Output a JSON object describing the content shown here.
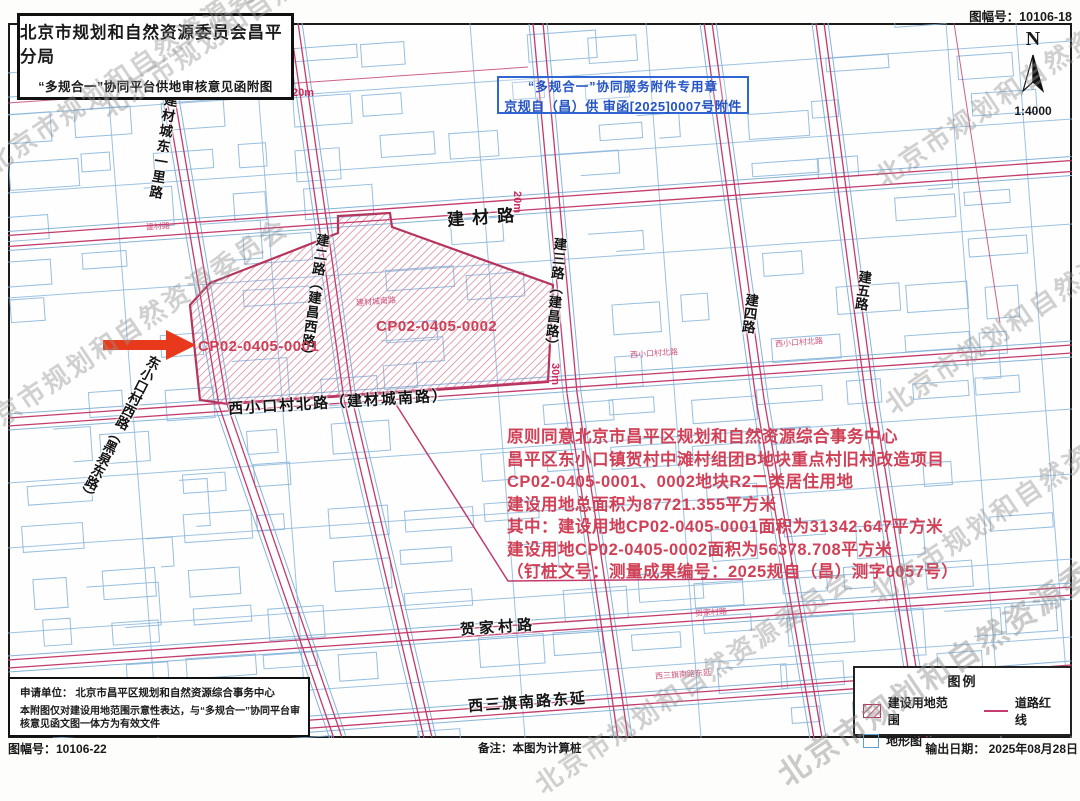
{
  "page": {
    "sheet_no_top": "图幅号：10106-18",
    "sheet_no_bottom": "图幅号：10106-22",
    "remark": "备注：本图为计算桩",
    "output_date": "输出日期： 2025年08月28日",
    "watermark": "北京市规划和自然资源委员会"
  },
  "header": {
    "title": "北京市规划和自然资源委员会昌平分局",
    "subtitle": "“多规合一”协同平台供地审核意见函附图"
  },
  "compass": {
    "north": "N",
    "scale": "1:4000"
  },
  "stamp": {
    "line1": "“多规合一”协同服务附件专用章",
    "line2": "京规自（昌）供 审函[2025]0007号附件"
  },
  "map": {
    "roads": {
      "jiancai": "建材路",
      "dongyili": "建材城东一里路",
      "jianer": "建二路（建昌西路）",
      "jiansan": "建三路（建昌路）",
      "jiansi": "建四路",
      "jianwu": "建五路",
      "xikou_north": "西小口村北路（建材城南路）",
      "dongxikou_west": "东小口村西路（黑泉东路）",
      "hejia": "贺家村路",
      "xisanqi": "西三旗南路东延"
    },
    "dims": [
      "20m",
      "20m",
      "30m"
    ],
    "parcels": [
      "CP02-0405-0001",
      "CP02-0405-0002"
    ],
    "minor_labels": [
      "西小口村北路",
      "西小口村北路",
      "贺家村路",
      "西三旗南路东延",
      "建材路",
      "建材城南路"
    ]
  },
  "annotation": {
    "lines": [
      "原则同意北京市昌平区规划和自然资源综合事务中心",
      "昌平区东小口镇贺村中滩村组团B地块重点村旧村改造项目",
      "CP02-0405-0001、0002地块R2二类居住用地",
      "建设用地总面积为87721.355平方米",
      "其中：建设用地CP02-0405-0001面积为31342.647平方米",
      "建设用地CP02-0405-0002面积为56378.708平方米",
      "（钉桩文号：测量成果编号：2025规自（昌）测字0057号）"
    ]
  },
  "footer_box": {
    "applicant": "申请单位：  北京市昌平区规划和自然资源综合事务中心",
    "note": "本附图仅对建设用地范围示意性表达，与“多规合一”协同平台审核意见函文图一体方为有效文件"
  },
  "legend": {
    "title": "图例",
    "items": [
      {
        "label": "建设用地范围"
      },
      {
        "label": "道路红线"
      },
      {
        "label": "地形图"
      }
    ]
  },
  "colors": {
    "road_red": "#c23a6e",
    "topo_blue": "#86b4da",
    "hatch_pink": "#d4738f",
    "parcel_border": "#b5345c",
    "annotation_red": "#d04056",
    "stamp_blue": "#2353c4",
    "arrow_red": "#e8391c"
  }
}
